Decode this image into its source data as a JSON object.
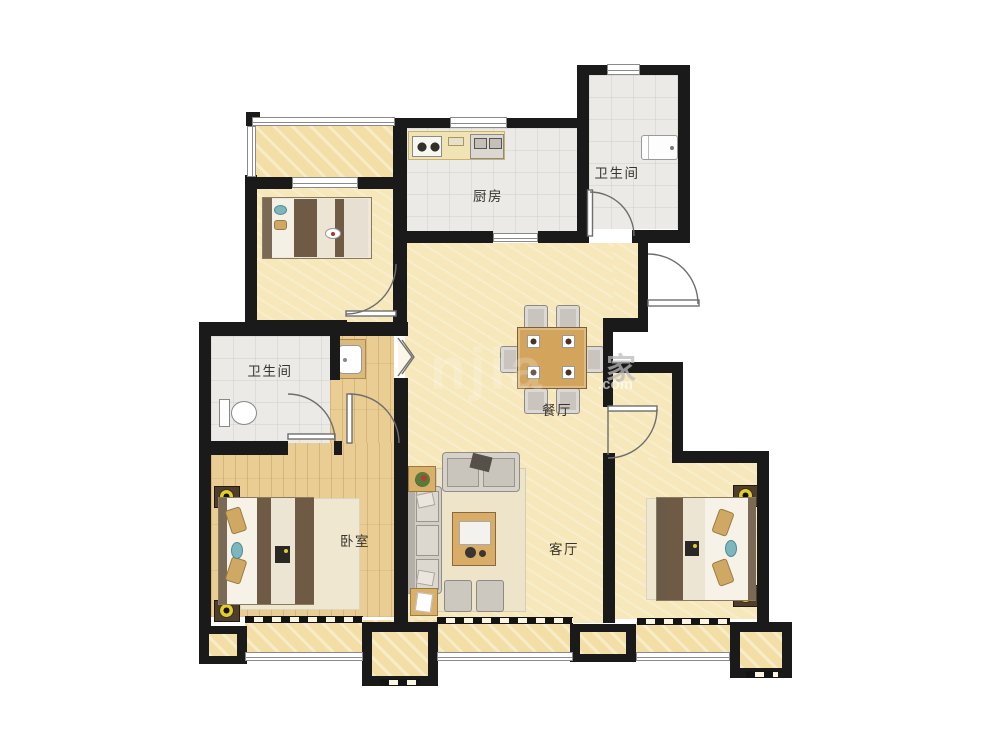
{
  "rooms": {
    "kitchen": {
      "label": "厨房"
    },
    "bathroom_top": {
      "label": "卫生间"
    },
    "bathroom_left": {
      "label": "卫生间"
    },
    "dining": {
      "label": "餐厅"
    },
    "living": {
      "label": "客厅"
    },
    "bedroom_master": {
      "label": "卧室"
    }
  },
  "watermark": {
    "big_letters": "njia",
    "cn_char": "家",
    "suffix": ".com"
  },
  "colors": {
    "wall": "#1a1a1a",
    "floor_yellow": "#f6e8ba",
    "floor_wood": "#e9cd92",
    "floor_tile": "#ebeae6",
    "furniture_wood": "#d2a45c",
    "blanket_brown": "#6f5b45",
    "pillow_teal": "#7db6bc",
    "lamp_yellow": "#e2cd2e",
    "sofa_gray": "#d2cec6"
  }
}
